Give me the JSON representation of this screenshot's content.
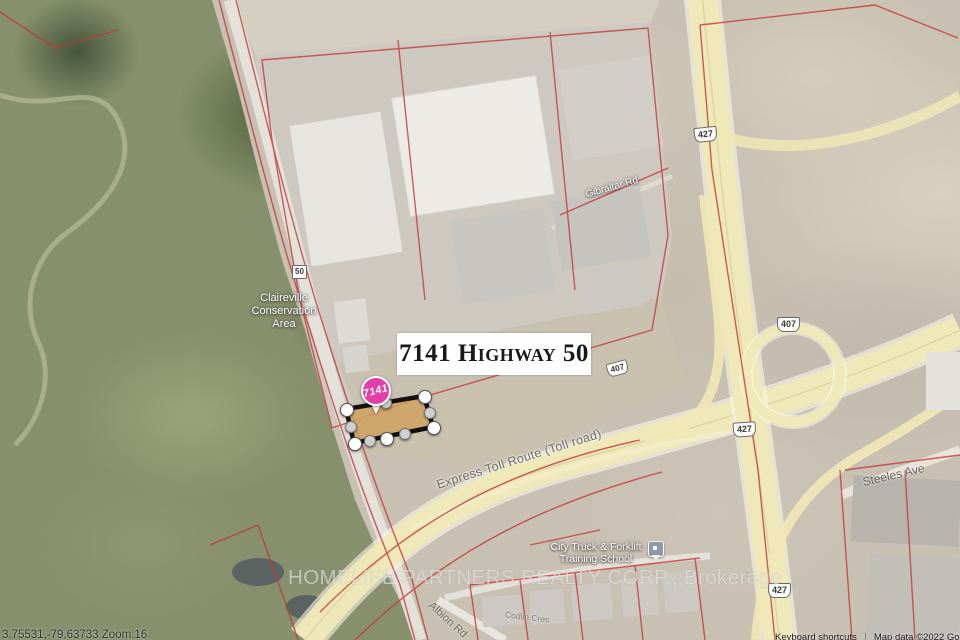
{
  "address_card": {
    "label": "7141 Highway 50"
  },
  "marker": {
    "label": "7141"
  },
  "map_labels": {
    "conservation_area": "Claireville\nConservation\nArea",
    "gibraltar_rd": "Gibraltar Rd",
    "express_toll": "Express Toll Route (Toll road)",
    "steeles_ave": "Steeles Ave",
    "albion_rd": "Albion Rd",
    "codlin_cres": "Codlin Cres",
    "school": "City Truck & Forklift\nTraining School"
  },
  "shields": {
    "hwy427_north": "427",
    "hwy407_east": "407",
    "hwy407_mid": "407",
    "hwy427_mid": "427",
    "hwy427_south": "427",
    "hwy50": "50"
  },
  "watermark": "HOMELIFE PARTNERS REALTY CORP., Brokerage",
  "status": {
    "coordinates": "3.75531,-79.63733 Zoom:16"
  },
  "attribution": {
    "keyboard_shortcuts": "Keyboard shortcuts",
    "map_data": "Map data ©2022 Google"
  },
  "colors": {
    "highway_fill": "#efe8b6",
    "parcel_boundary_red": "#c43434",
    "selection_fill": "#cfa263",
    "selection_border": "#111111",
    "marker_pink": "#e33fa8"
  }
}
